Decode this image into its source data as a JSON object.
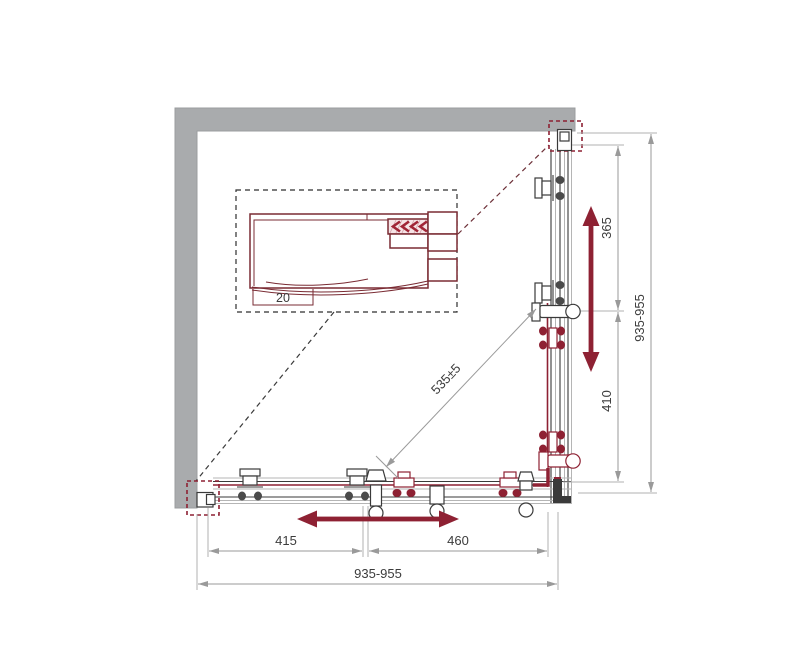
{
  "drawing": {
    "title": "corner-shower-enclosure-technical-drawing",
    "dimensions": {
      "right_total": "935-955",
      "right_upper_segment": "365",
      "right_lower_segment": "410",
      "bottom_total": "935-955",
      "bottom_left_segment": "415",
      "bottom_right_segment": "460",
      "diagonal": "535±5",
      "detail_profile": "20"
    },
    "colors": {
      "wall_gray": "#a9abad",
      "profile_maroon": "#7a2b33",
      "accent_red": "#8e2133",
      "dimension_gray": "#9a9a9a",
      "text_gray": "#3c3c3c",
      "frame_dark": "#3a3a3a"
    }
  }
}
